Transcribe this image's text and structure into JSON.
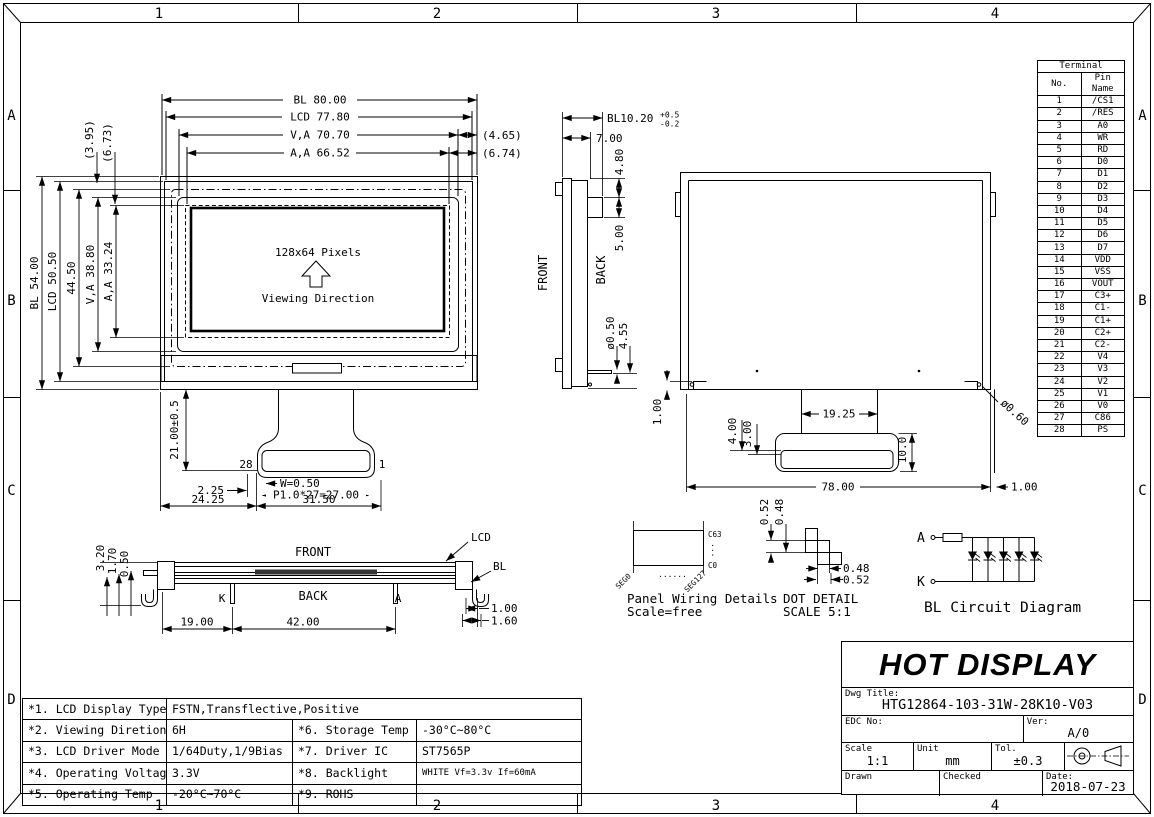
{
  "border": {
    "cols": [
      "1",
      "2",
      "3",
      "4"
    ],
    "rows": [
      "A",
      "B",
      "C",
      "D"
    ]
  },
  "colors": {
    "line": "#000000",
    "bg": "#ffffff",
    "polarizer": "#333333"
  },
  "front_view": {
    "pixels": "128x64 Pixels",
    "viewing": "Viewing Direction",
    "pin_last": "28",
    "pin_first": "1",
    "dims": {
      "bl_w": "BL 80.00",
      "lcd_w": "LCD 77.80",
      "va_w": "V,A 70.70",
      "aa_w": "A,A 66.52",
      "gap_r1": "(4.65)",
      "gap_r2": "(6.74)",
      "gap_l1": "(3.95)",
      "gap_l2": "(6.73)",
      "bl_h": "BL 54.00",
      "lcd_h": "LCD 50.50",
      "mid_h": "44.50",
      "va_h": "V,A 38.80",
      "aa_h": "A,A 33.24",
      "fpc_len": "21.00±0.5",
      "edge": "2.25",
      "pin_w": "W=0.50",
      "pitch": "P1.0*27=27.00",
      "off": "24.25",
      "conn_w": "31.50"
    }
  },
  "side_view": {
    "front": "FRONT",
    "back": "BACK",
    "dims": {
      "bl_t": "BL10.20",
      "tol_p": "+0.5",
      "tol_m": "-0.2",
      "d7": "7.00",
      "d48": "4.80",
      "d5": "5.00",
      "pin_d": "ø0.50",
      "d455": "4.55"
    }
  },
  "back_view": {
    "dims": {
      "wall_l": "1.00",
      "fpc_gap": "19.25",
      "d4": "4.00",
      "d3": "3.00",
      "d10": "10.0",
      "w": "78.00",
      "wall_r": "1.00",
      "pin_d": "ø0.60"
    }
  },
  "bottom_view": {
    "front": "FRONT",
    "back": "BACK",
    "k": "K",
    "a": "A",
    "lcd": "LCD",
    "bl": "BL",
    "dims": {
      "t1": "3.20",
      "t2": "1.70",
      "t3": "0.50",
      "l1": "19.00",
      "l2": "42.00",
      "r1": "1.00",
      "r2": "1.60"
    }
  },
  "panel_wiring": {
    "title": "Panel Wiring Details",
    "scale": "Scale=free",
    "c63": "C63",
    "c0": "C0",
    "seg0": "SEG0",
    "seg127": "SEG127",
    "dots": "......",
    "vdots": "..."
  },
  "dot_detail": {
    "title": "DOT DETAIL",
    "scale": "SCALE 5:1",
    "h1": "0.52",
    "h2": "0.48",
    "w1": "0.48",
    "w2": "0.52"
  },
  "bl_circuit": {
    "title": "BL Circuit Diagram",
    "anode": "A",
    "cathode": "K"
  },
  "terminal_table": {
    "title": "Terminal",
    "col_no": "No.",
    "col_name": "Pin Name",
    "pins": [
      {
        "no": "1",
        "name": "/CS1"
      },
      {
        "no": "2",
        "name": "/RES"
      },
      {
        "no": "3",
        "name": "A0"
      },
      {
        "no": "4",
        "name": "WR"
      },
      {
        "no": "5",
        "name": "RD"
      },
      {
        "no": "6",
        "name": "D0"
      },
      {
        "no": "7",
        "name": "D1"
      },
      {
        "no": "8",
        "name": "D2"
      },
      {
        "no": "9",
        "name": "D3"
      },
      {
        "no": "10",
        "name": "D4"
      },
      {
        "no": "11",
        "name": "D5"
      },
      {
        "no": "12",
        "name": "D6"
      },
      {
        "no": "13",
        "name": "D7"
      },
      {
        "no": "14",
        "name": "VDD"
      },
      {
        "no": "15",
        "name": "VSS"
      },
      {
        "no": "16",
        "name": "VOUT"
      },
      {
        "no": "17",
        "name": "C3+"
      },
      {
        "no": "18",
        "name": "C1-"
      },
      {
        "no": "19",
        "name": "C1+"
      },
      {
        "no": "20",
        "name": "C2+"
      },
      {
        "no": "21",
        "name": "C2-"
      },
      {
        "no": "22",
        "name": "V4"
      },
      {
        "no": "23",
        "name": "V3"
      },
      {
        "no": "24",
        "name": "V2"
      },
      {
        "no": "25",
        "name": "V1"
      },
      {
        "no": "26",
        "name": "V0"
      },
      {
        "no": "27",
        "name": "C86"
      },
      {
        "no": "28",
        "name": "PS"
      }
    ]
  },
  "spec_table": {
    "rows": [
      {
        "c1": "*1. LCD Display Type",
        "c2": "FSTN,Transflective,Positive",
        "c3": "",
        "c4": ""
      },
      {
        "c1": "*2. Viewing Diretion",
        "c2": "6H",
        "c3": "*6. Storage Temp",
        "c4": "-30°C~80°C"
      },
      {
        "c1": "*3. LCD Driver Mode",
        "c2": "1/64Duty,1/9Bias",
        "c3": "*7. Driver IC",
        "c4": "ST7565P"
      },
      {
        "c1": "*4. Operating Voltage",
        "c2": "3.3V",
        "c3": "*8. Backlight",
        "c4": "WHITE Vf=3.3v If=60mA"
      },
      {
        "c1": "*5. Operating Temp",
        "c2": "-20°C~70°C",
        "c3": "*9. ROHS",
        "c4": ""
      }
    ]
  },
  "title_block": {
    "company": "HOT DISPLAY",
    "dwg_title_label": "Dwg Title:",
    "dwg_title": "HTG12864-103-31W-28K10-V03",
    "edc_label": "EDC No:",
    "ver_label": "Ver:",
    "ver": "A/0",
    "scale_label": "Scale",
    "scale": "1:1",
    "unit_label": "Unit",
    "unit": "mm",
    "tol_label": "Tol.",
    "tol": "±0.3",
    "drawn_label": "Drawn",
    "checked_label": "Checked",
    "date_label": "Date:",
    "date": "2018-07-23"
  }
}
